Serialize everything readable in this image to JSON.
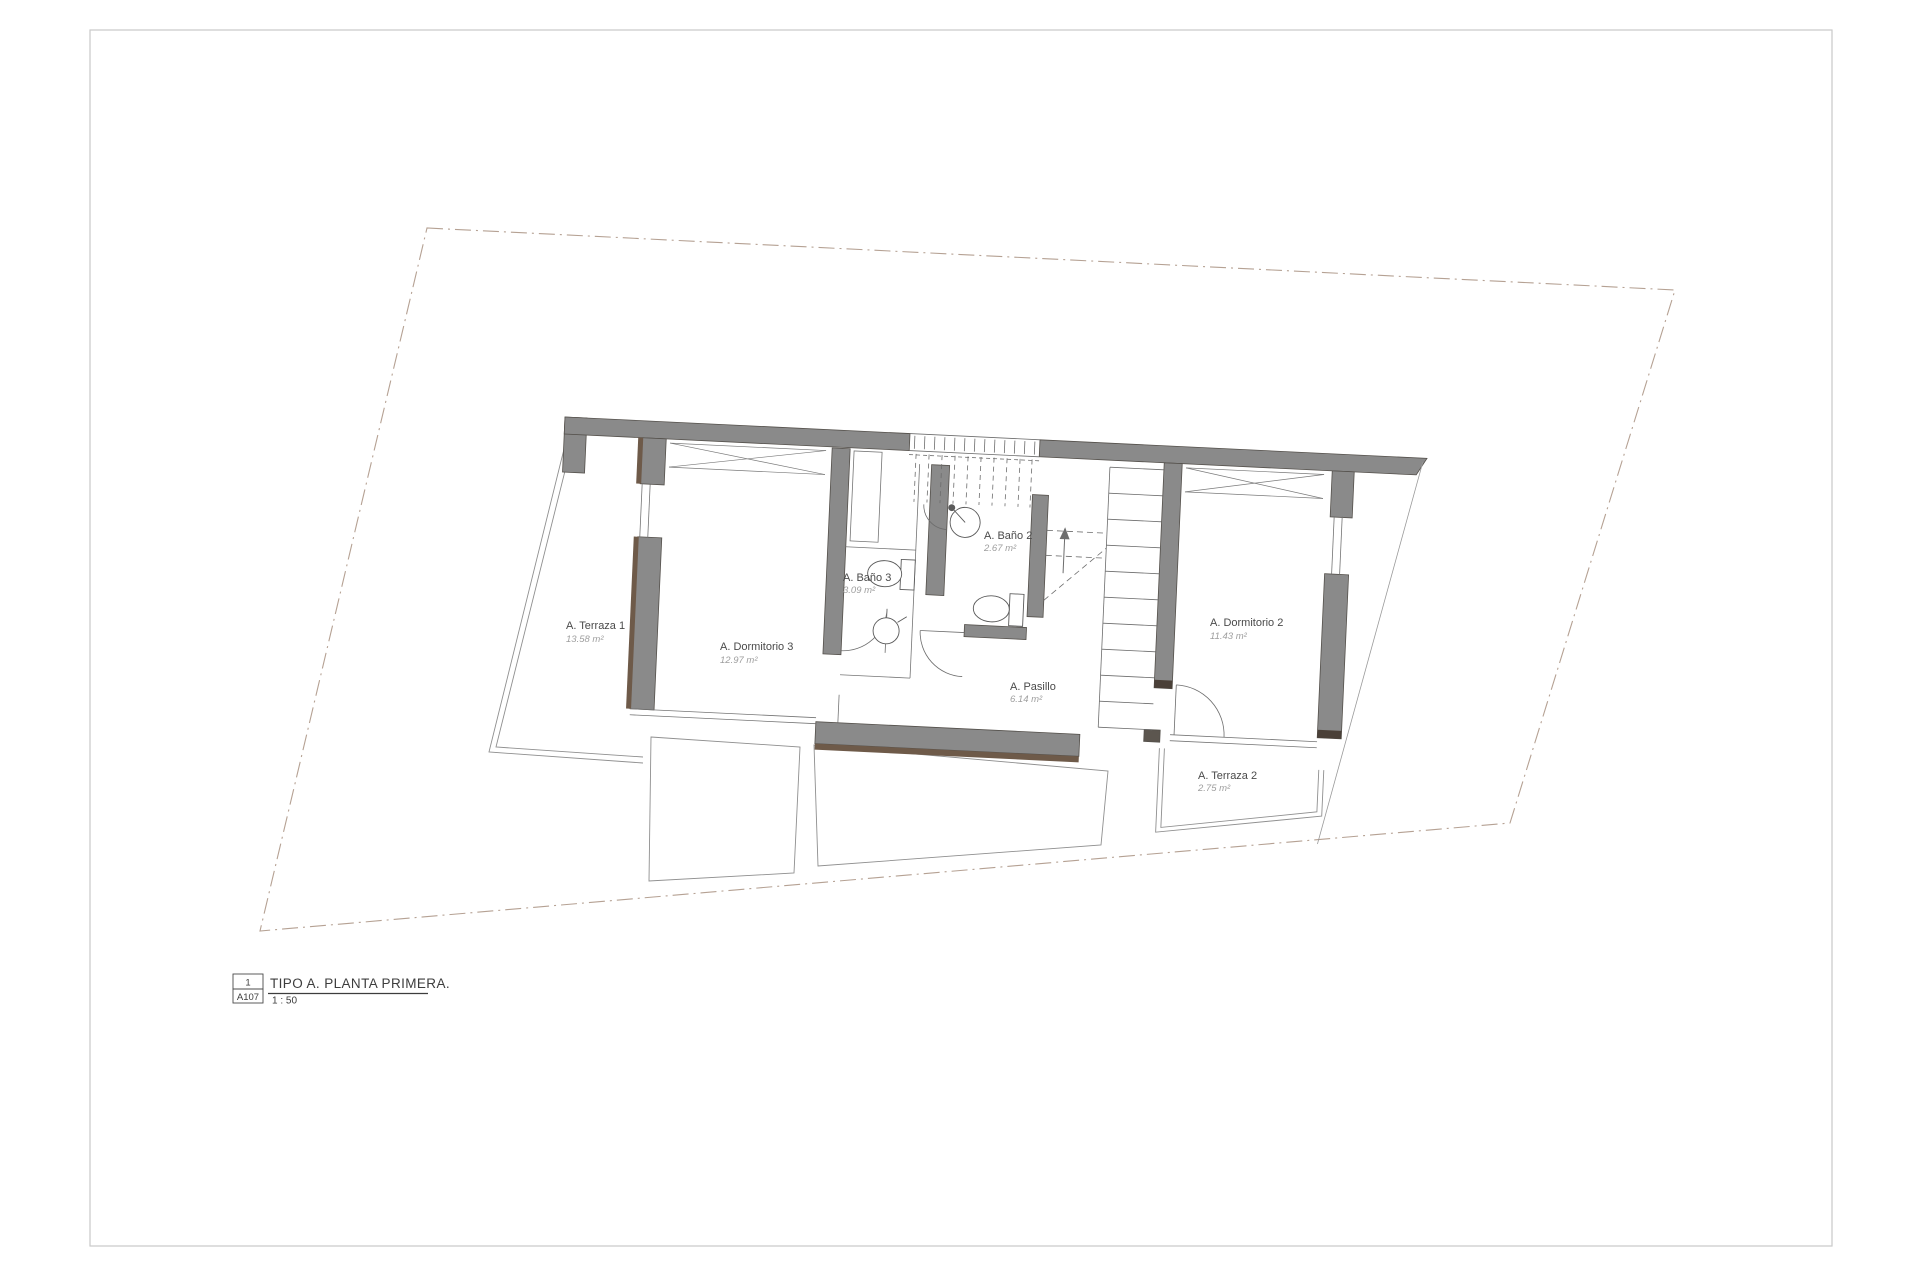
{
  "title_block": {
    "detail_number": "1",
    "sheet_number": "A107",
    "title": "TIPO A. PLANTA PRIMERA.",
    "scale": "1 : 50"
  },
  "rooms": [
    {
      "name": "A. Terraza 1",
      "area": "13.58 m²"
    },
    {
      "name": "A. Dormitorio 3",
      "area": "12.97 m²"
    },
    {
      "name": "A. Baño 3",
      "area": "3.09 m²"
    },
    {
      "name": "A. Baño 2",
      "area": "2.67 m²"
    },
    {
      "name": "A. Pasillo",
      "area": "6.14 m²"
    },
    {
      "name": "A. Dormitorio 2",
      "area": "11.43 m²"
    },
    {
      "name": "A. Terraza 2",
      "area": "2.75 m²"
    }
  ],
  "colors": {
    "wall_fill": "#8a8a8a",
    "wall_outline": "#54504b",
    "wood_accent": "#6e5a49",
    "thin_line": "#757575",
    "boundary": "#b5a193",
    "sheet_border": "#c9c9c9"
  }
}
